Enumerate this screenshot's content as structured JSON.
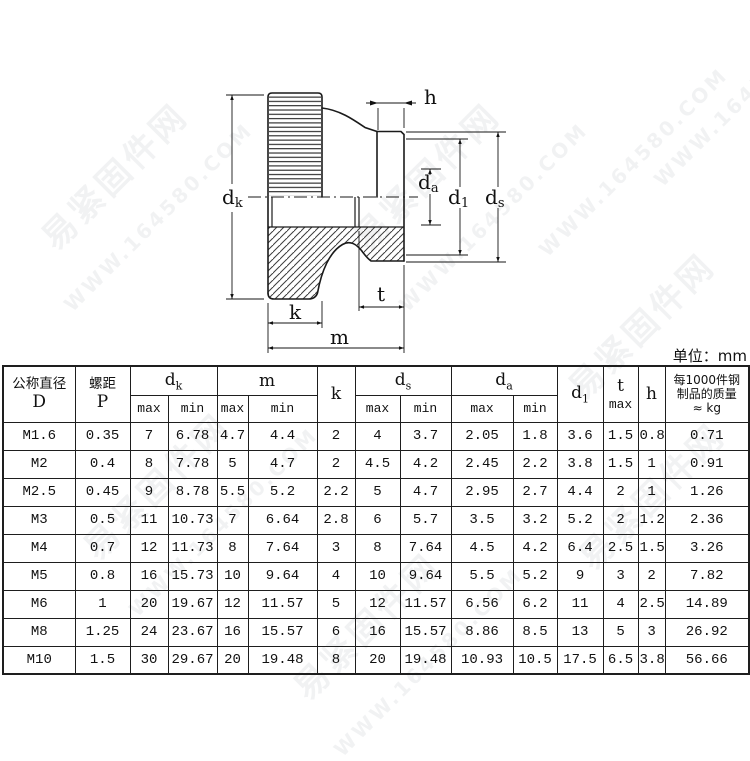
{
  "page": {
    "unit_label": "单位：mm"
  },
  "watermark": {
    "site_name": "易紧固件网",
    "site_url": "WWW.164580.COM"
  },
  "drawing": {
    "labels": {
      "dk": {
        "base": "d",
        "sub": "k"
      },
      "m": "m",
      "k": "k",
      "t": "t",
      "h": "h",
      "da": {
        "base": "d",
        "sub": "a"
      },
      "d1": {
        "base": "d",
        "sub": "1"
      },
      "ds": {
        "base": "d",
        "sub": "s"
      }
    }
  },
  "table": {
    "header": {
      "d_label": "公称直径",
      "d_symbol": "D",
      "p_label": "螺距",
      "p_symbol": "P",
      "group_dk": {
        "base": "d",
        "sub": "k"
      },
      "group_m": "m",
      "col_k": "k",
      "group_ds": {
        "base": "d",
        "sub": "s"
      },
      "group_da": {
        "base": "d",
        "sub": "a"
      },
      "col_d1": {
        "base": "d",
        "sub": "1"
      },
      "col_t": "t",
      "col_h": "h",
      "sub_max": "max",
      "sub_min": "min",
      "mass_line1": "每1000件钢",
      "mass_line2": "制品的质量",
      "mass_line3": "≈ kg"
    },
    "rows": [
      [
        "M1.6",
        "0.35",
        "7",
        "6.78",
        "4.7",
        "4.4",
        "2",
        "4",
        "3.7",
        "2.05",
        "1.8",
        "3.6",
        "1.5",
        "0.8",
        "0.71"
      ],
      [
        "M2",
        "0.4",
        "8",
        "7.78",
        "5",
        "4.7",
        "2",
        "4.5",
        "4.2",
        "2.45",
        "2.2",
        "3.8",
        "1.5",
        "1",
        "0.91"
      ],
      [
        "M2.5",
        "0.45",
        "9",
        "8.78",
        "5.5",
        "5.2",
        "2.2",
        "5",
        "4.7",
        "2.95",
        "2.7",
        "4.4",
        "2",
        "1",
        "1.26"
      ],
      [
        "M3",
        "0.5",
        "11",
        "10.73",
        "7",
        "6.64",
        "2.8",
        "6",
        "5.7",
        "3.5",
        "3.2",
        "5.2",
        "2",
        "1.2",
        "2.36"
      ],
      [
        "M4",
        "0.7",
        "12",
        "11.73",
        "8",
        "7.64",
        "3",
        "8",
        "7.64",
        "4.5",
        "4.2",
        "6.4",
        "2.5",
        "1.5",
        "3.26"
      ],
      [
        "M5",
        "0.8",
        "16",
        "15.73",
        "10",
        "9.64",
        "4",
        "10",
        "9.64",
        "5.5",
        "5.2",
        "9",
        "3",
        "2",
        "7.82"
      ],
      [
        "M6",
        "1",
        "20",
        "19.67",
        "12",
        "11.57",
        "5",
        "12",
        "11.57",
        "6.56",
        "6.2",
        "11",
        "4",
        "2.5",
        "14.89"
      ],
      [
        "M8",
        "1.25",
        "24",
        "23.67",
        "16",
        "15.57",
        "6",
        "16",
        "15.57",
        "8.86",
        "8.5",
        "13",
        "5",
        "3",
        "26.92"
      ],
      [
        "M10",
        "1.5",
        "30",
        "29.67",
        "20",
        "19.48",
        "8",
        "20",
        "19.48",
        "10.93",
        "10.5",
        "17.5",
        "6.5",
        "3.8",
        "56.66"
      ]
    ]
  }
}
